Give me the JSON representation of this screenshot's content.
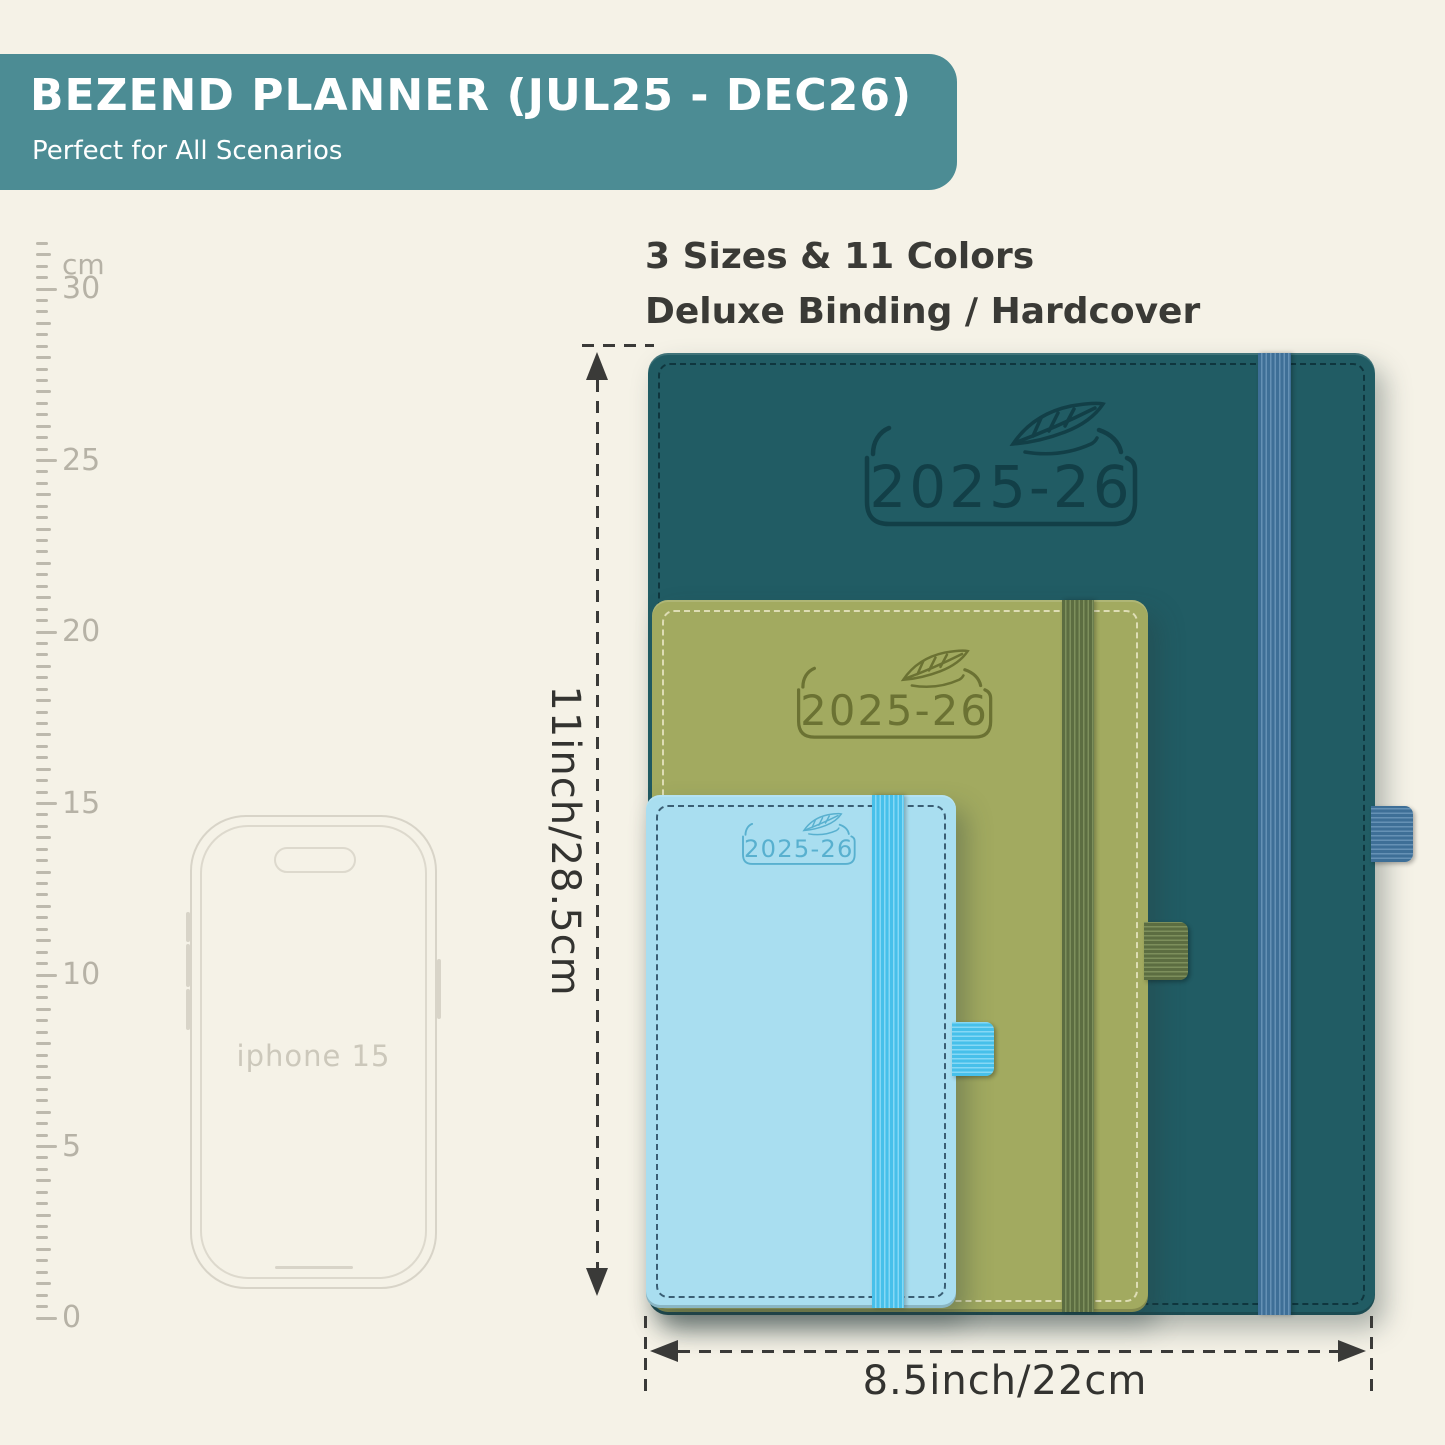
{
  "banner": {
    "title": "BEZEND PLANNER (JUL25 - DEC26)",
    "subtitle": "Perfect for All Scenarios",
    "bg": "#4c8c94",
    "text_color": "#ffffff"
  },
  "headline": {
    "line1": "3 Sizes & 11 Colors",
    "line2": "Deluxe Binding / Hardcover"
  },
  "ruler": {
    "unit_label": "cm",
    "labels": [
      "30",
      "25",
      "20",
      "15",
      "10",
      "5",
      "0"
    ]
  },
  "phone": {
    "label": "iphone 15"
  },
  "planners": [
    {
      "size": "large",
      "year_label": "2025-26",
      "cover": "#215c64",
      "emboss": "#123f47",
      "stitch": "#0d3038",
      "band": "#3e6f97",
      "band_stripe": "#6591b5"
    },
    {
      "size": "medium",
      "year_label": "2025-26",
      "cover": "#a2aa60",
      "emboss": "#6b7233",
      "stitch": "#e9e7c4",
      "band": "#5c6d41",
      "band_stripe": "#7d8f5c"
    },
    {
      "size": "small",
      "year_label": "2025-26",
      "cover": "#a9def0",
      "emboss": "#58b0cf",
      "stitch": "#27485f",
      "band": "#47c0ea",
      "band_stripe": "#86d8f5"
    }
  ],
  "dimensions": {
    "height_label": "11inch/28.5cm",
    "width_label": "8.5inch/22cm",
    "line_color": "#3a3a38"
  }
}
